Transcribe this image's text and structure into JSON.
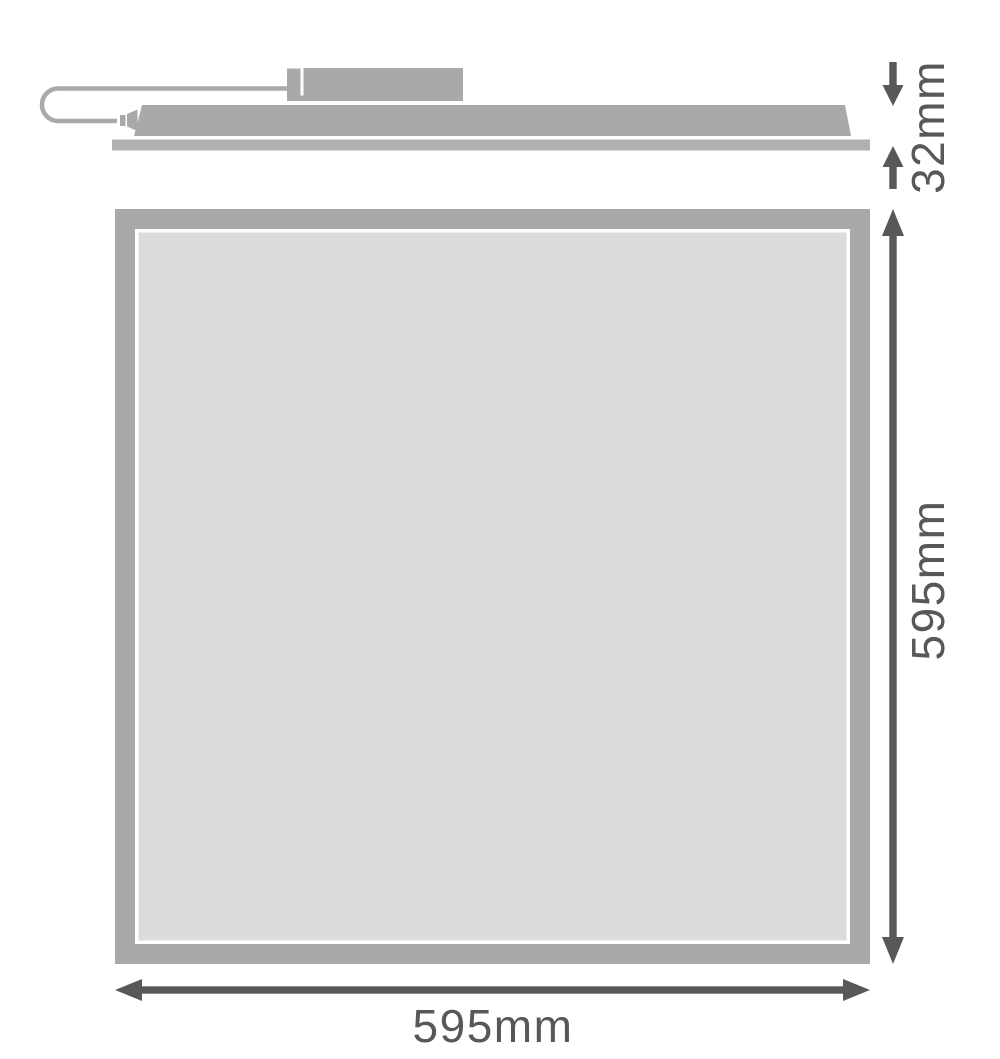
{
  "diagram": {
    "kind": "technical-dimension-drawing",
    "side_view": {
      "thickness_label": "32mm",
      "parts": [
        "power-cable",
        "plug-connector",
        "driver-box",
        "panel-body",
        "back-plate"
      ]
    },
    "front_view": {
      "height_label": "595mm",
      "width_label": "595mm"
    },
    "colors": {
      "product_gray": "#a9a9a9",
      "back_plate_gray": "#b0b0b0",
      "panel_surface_gray": "#dcdcdc",
      "frame_inner_line": "#ffffff",
      "dimension_dark_gray": "#58585a",
      "background": "#ffffff"
    }
  }
}
